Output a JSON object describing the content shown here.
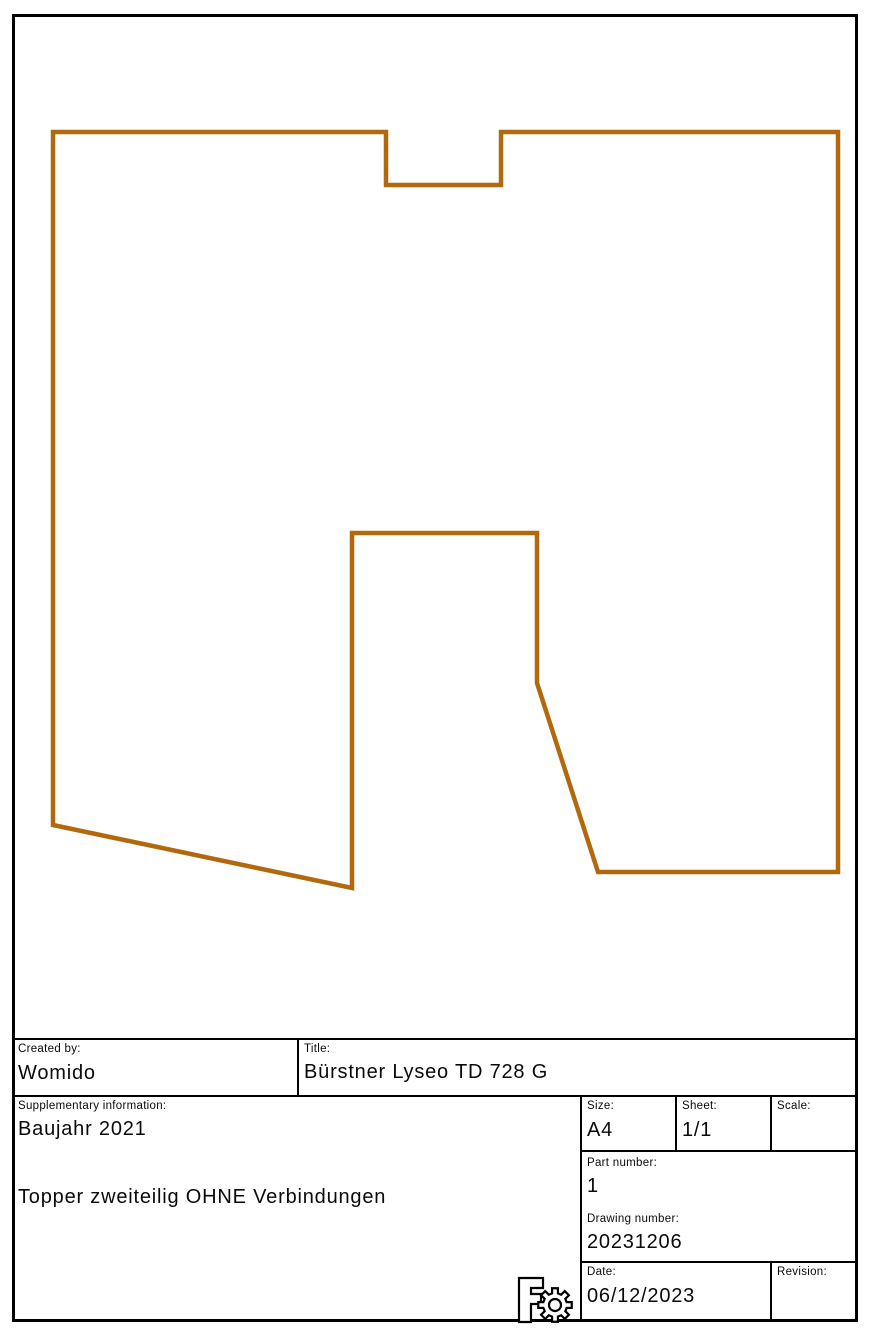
{
  "drawing": {
    "outline_color": "#b2690e",
    "outline_points": "53,132 386,132 386,185 501,185 501,132 838,132 838,872 598,872 537,683 537,533 352,533 352,888 53,825"
  },
  "title_block": {
    "created_by": {
      "label": "Created by:",
      "value": "Womido"
    },
    "title": {
      "label": "Title:",
      "value": "Bürstner Lyseo TD 728 G"
    },
    "supplementary": {
      "label": "Supplementary information:",
      "line1": "Baujahr 2021",
      "line2": "Topper zweiteilig OHNE Verbindungen"
    },
    "size": {
      "label": "Size:",
      "value": "A4"
    },
    "sheet": {
      "label": "Sheet:",
      "value": "1/1"
    },
    "scale": {
      "label": "Scale:",
      "value": ""
    },
    "part_number": {
      "label": "Part number:",
      "value": "1"
    },
    "drawing_number": {
      "label": "Drawing number:",
      "value": "20231206"
    },
    "date": {
      "label": "Date:",
      "value": "06/12/2023"
    },
    "revision": {
      "label": "Revision:",
      "value": ""
    },
    "logo": "freecad-gear-logo"
  }
}
